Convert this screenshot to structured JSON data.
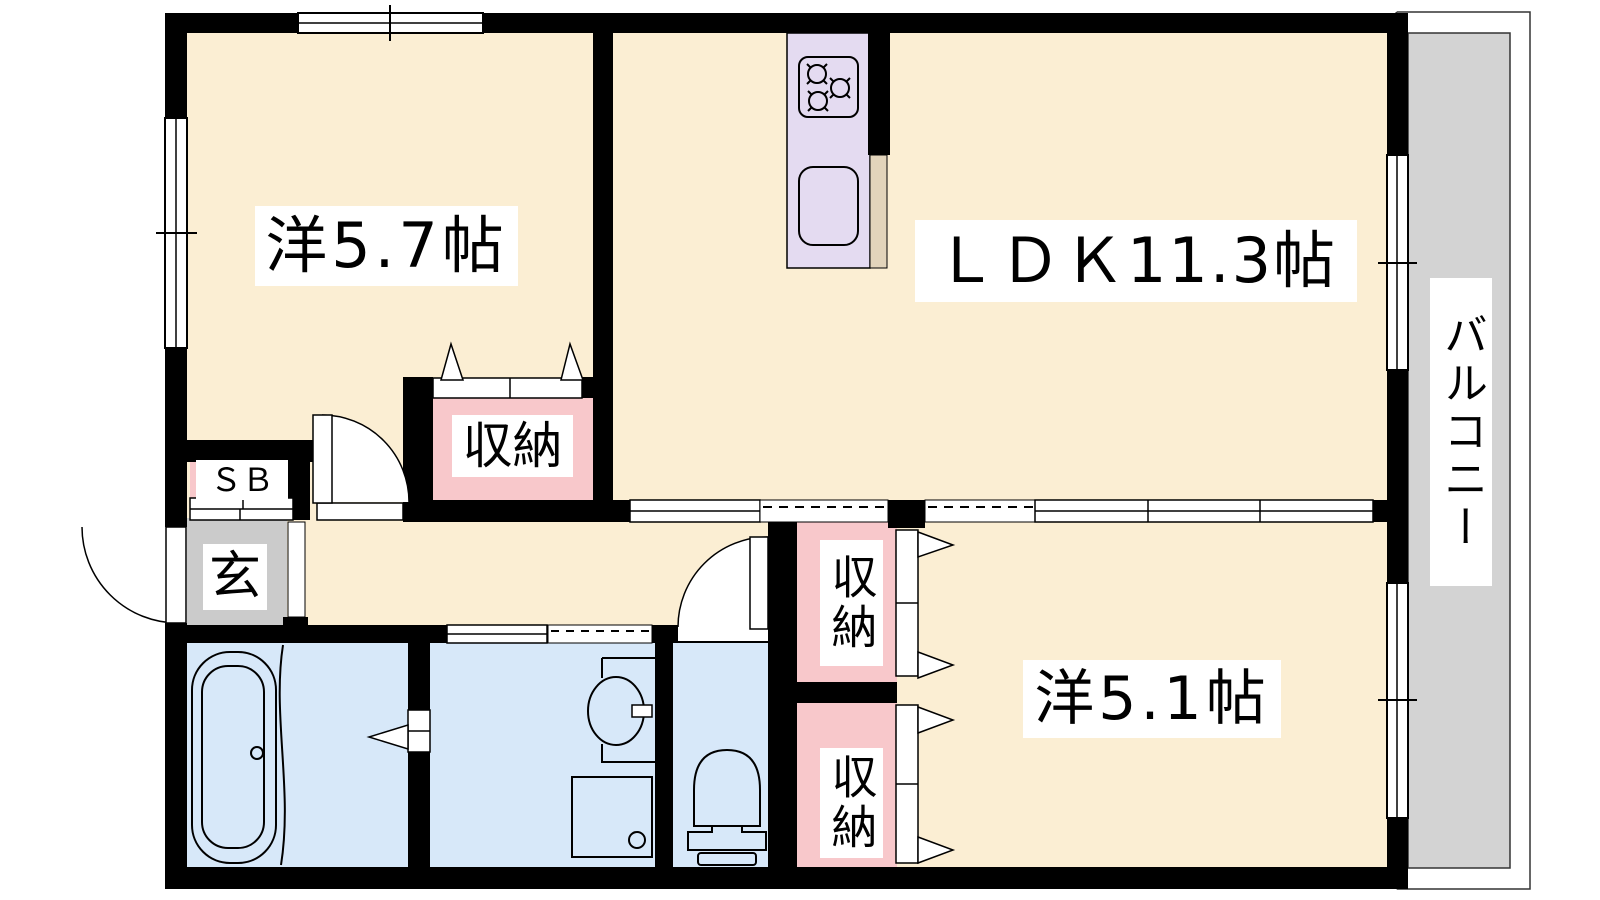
{
  "floorplan": {
    "labels": {
      "room_5_7": "洋5.7帖",
      "ldk": "ＬＤＫ11.3帖",
      "room_5_1": "洋5.1帖",
      "balcony": "バルコニー",
      "genkan": "玄",
      "shoe_box": "ＳＢ",
      "closet_room_5_7": "収納",
      "closet_upper": "収納",
      "closet_lower": "収納"
    },
    "colors": {
      "floor": "#FBEED3",
      "wet_area": "#D7E8F9",
      "closet": "#F8C8CB",
      "entrance": "#CBCBCB",
      "balcony": "#D3D3D3",
      "kitchen_unit": "#E4DBF1",
      "counter": "#E2D4BB",
      "wall": "#000000",
      "label_background": "#FFFFFF"
    }
  }
}
